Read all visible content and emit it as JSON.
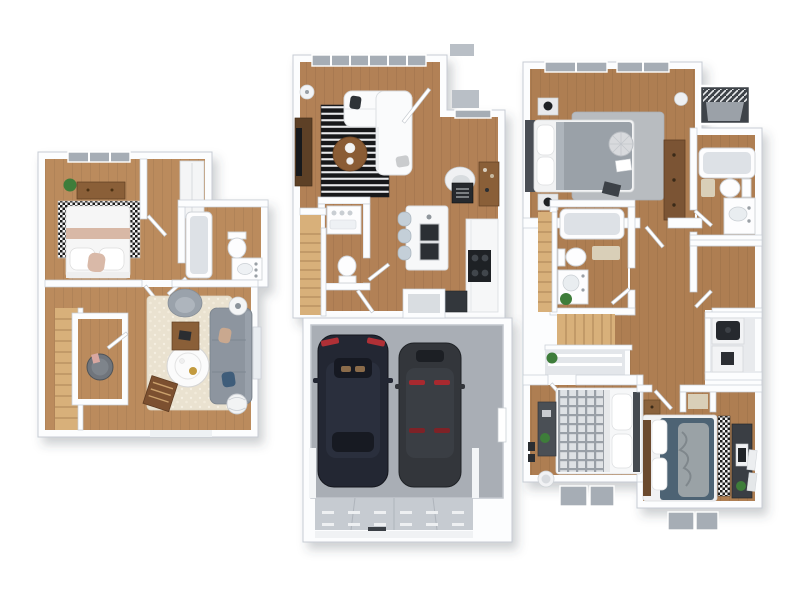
{
  "image_type": "3d-floor-plan-render",
  "background": "#ffffff",
  "palette": {
    "wall": "#fcfdfe",
    "wall-edge": "#c7ccd4",
    "wood-left": "#bb8b5d",
    "wood-mid": "#b28156",
    "wood-right": "#ae7e52",
    "wood-furn": "#8a5f38",
    "stair": "#d8b07a",
    "glass": "#a6adb5",
    "pad": "#b9bfc6",
    "sofa": "#8d959f",
    "plant": "#3e7d3a",
    "mat": "#d9cfb8",
    "rug-cream": "#eae2d0",
    "rug-gray": "#b8bcc0",
    "garage-floor": "#a9aeb5",
    "car-navy": "#232733",
    "car-charcoal": "#33363b",
    "taillight-red": "#b03036",
    "teal-bed": "#4d6374",
    "blush": "#d8b8a6",
    "cooktop-black": "#1e2125"
  },
  "plans": [
    {
      "id": "left",
      "name": "lower-level-unit",
      "rooms": [
        {
          "name": "bedroom",
          "furniture": [
            "bed-white-blush",
            "checkered-rug",
            "dresser",
            "potted-plant",
            "window"
          ]
        },
        {
          "name": "bathroom",
          "furniture": [
            "bathtub-shower",
            "toilet",
            "vanity-sink"
          ]
        },
        {
          "name": "living-room",
          "furniture": [
            "shag-rug",
            "gray-sofa",
            "armchair",
            "round-coffee-table",
            "desk-with-laptop",
            "magazine-rack",
            "side-table",
            "basket",
            "window"
          ]
        },
        {
          "name": "staircase",
          "furniture": [
            "wood-steps"
          ]
        },
        {
          "name": "utility-closet",
          "furniture": [
            "water-heater"
          ]
        }
      ]
    },
    {
      "id": "middle",
      "name": "main-level-unit",
      "rooms": [
        {
          "name": "living-dining-room",
          "furniture": [
            "striped-rug",
            "white-sectional-sofa",
            "round-dining-table",
            "tv-console",
            "floor-lamp",
            "window-wall"
          ]
        },
        {
          "name": "entry",
          "furniture": [
            "armchair",
            "decor-sign",
            "bar-cabinet",
            "front-door",
            "coat-closet"
          ]
        },
        {
          "name": "kitchen",
          "furniture": [
            "island-with-double-sink",
            "three-stools",
            "counter-with-cooktop",
            "base-cabinet",
            "window"
          ]
        },
        {
          "name": "powder-room",
          "furniture": [
            "vanity",
            "toilet"
          ]
        },
        {
          "name": "staircase",
          "furniture": [
            "wood-steps"
          ]
        },
        {
          "name": "garage",
          "capacity_cars": 2,
          "furniture": [
            "car-navy",
            "car-charcoal",
            "garage-door",
            "man-door",
            "driveway-apron"
          ]
        }
      ]
    },
    {
      "id": "right",
      "name": "upper-level-unit",
      "rooms": [
        {
          "name": "master-bedroom",
          "furniture": [
            "bed-gray",
            "gray-rug",
            "round-pouf",
            "two-nightstands-with-lamps",
            "long-dresser",
            "vase",
            "windows"
          ]
        },
        {
          "name": "balcony",
          "furniture": [
            "railing",
            "deck"
          ]
        },
        {
          "name": "master-bathroom",
          "furniture": [
            "bathtub",
            "toilet",
            "vanity-sink",
            "bath-mat"
          ]
        },
        {
          "name": "hall-bathroom",
          "furniture": [
            "bathtub",
            "toilet",
            "vanity-sink",
            "plant",
            "bath-mat"
          ]
        },
        {
          "name": "walk-in-closet",
          "furniture": []
        },
        {
          "name": "laundry-closet",
          "furniture": [
            "washer",
            "dryer"
          ]
        },
        {
          "name": "linen-closet",
          "furniture": [
            "shelves",
            "plant"
          ]
        },
        {
          "name": "staircase",
          "furniture": [
            "wood-steps"
          ]
        },
        {
          "name": "bedroom-2",
          "furniture": [
            "bed-plaid",
            "desk",
            "plant",
            "wall-frames",
            "hamper",
            "windows"
          ]
        },
        {
          "name": "bedroom-3",
          "furniture": [
            "bed-teal",
            "diamond-runner-rug",
            "dark-dresser",
            "nightstand",
            "leaning-frames",
            "windows"
          ]
        }
      ]
    }
  ]
}
